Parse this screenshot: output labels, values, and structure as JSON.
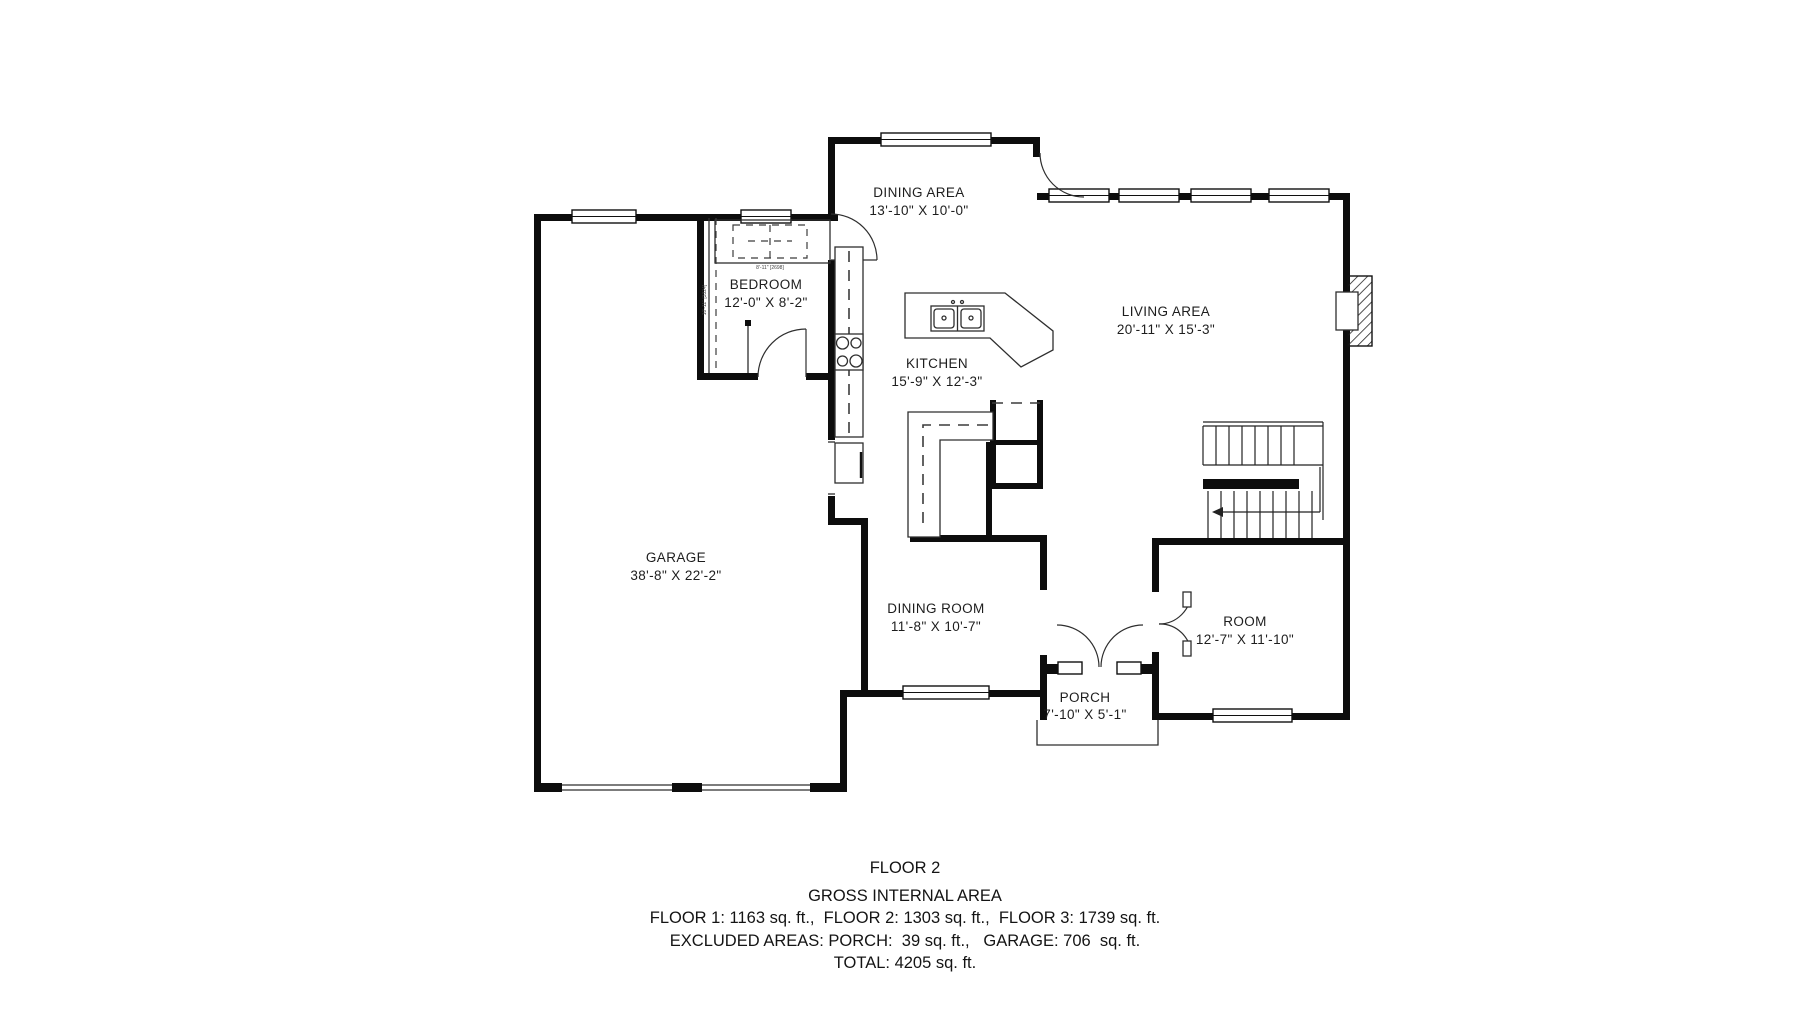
{
  "rooms": [
    {
      "name": "DINING AREA",
      "dims": "13'-10\" X 10'-0\""
    },
    {
      "name": "BEDROOM",
      "dims": "12'-0\" X 8'-2\""
    },
    {
      "name": "LIVING AREA",
      "dims": "20'-11\" X 15'-3\""
    },
    {
      "name": "KITCHEN",
      "dims": "15'-9\" X 12'-3\""
    },
    {
      "name": "GARAGE",
      "dims": "38'-8\" X 22'-2\""
    },
    {
      "name": "DINING ROOM",
      "dims": "11'-8\" X 10'-7\""
    },
    {
      "name": "ROOM",
      "dims": "12'-7\" X 11'-10\""
    },
    {
      "name": "PORCH",
      "dims": "7'-10\" X 5'-1\""
    }
  ],
  "annotations": {
    "bed_dim": "8'-11\" [2698]",
    "closet_dim": "10'-11\" [3324]"
  },
  "footer": {
    "title": "FLOOR 2",
    "subtitle": "GROSS INTERNAL AREA",
    "line1": "FLOOR 1: 1163 sq. ft.,  FLOOR 2: 1303 sq. ft.,  FLOOR 3: 1739 sq. ft.",
    "line2": "EXCLUDED AREAS: PORCH:  39 sq. ft.,   GARAGE: 706  sq. ft.",
    "line3": "TOTAL: 4205 sq. ft."
  },
  "colors": {
    "wall": "#0d0d0d",
    "thin_line": "#2e2e2e",
    "background": "#ffffff"
  }
}
